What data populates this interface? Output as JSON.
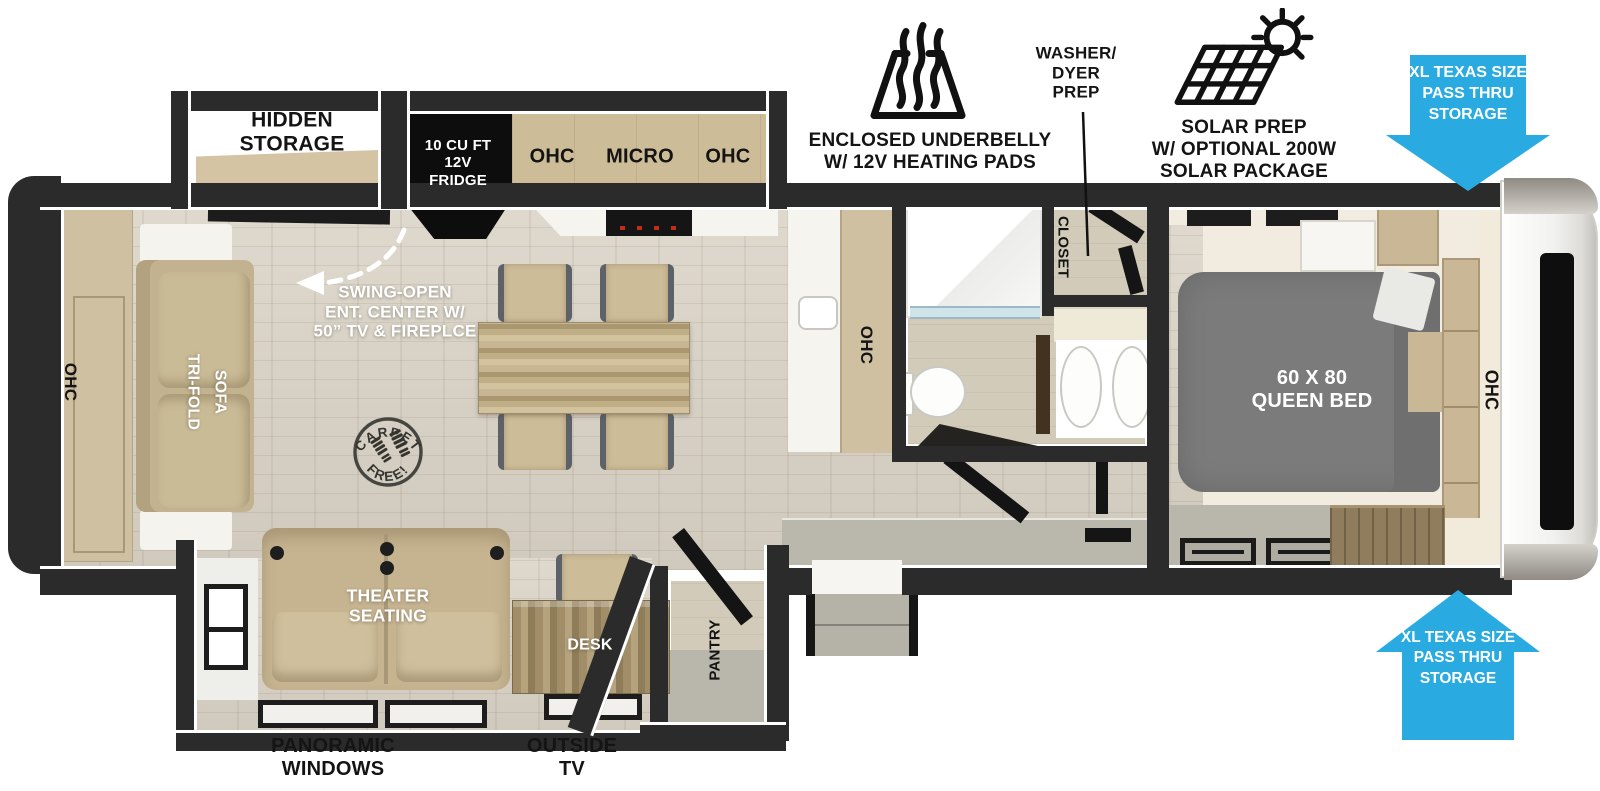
{
  "colors": {
    "accent_blue": "#29abe2",
    "wall_dark": "#2b2b2b",
    "floor_wood": "#d7d0c3",
    "cabinet_tan": "#cdbc98",
    "bed_gray": "#7b7b7b"
  },
  "annotations": {
    "underbelly": {
      "icon": "heating-pads-icon",
      "label": "ENCLOSED UNDERBELLY\nW/ 12V HEATING PADS"
    },
    "washer_dryer": {
      "label": "WASHER/\nDYER\nPREP"
    },
    "solar": {
      "icon": "solar-panel-sun-icon",
      "label": "SOLAR PREP\nW/ OPTIONAL 200W\nSOLAR PACKAGE"
    },
    "pass_thru_top": {
      "icon": "arrow-down",
      "label": "XL TEXAS SIZE\nPASS THRU\nSTORAGE"
    },
    "pass_thru_bottom": {
      "icon": "arrow-up",
      "label": "XL TEXAS SIZE\nPASS THRU\nSTORAGE"
    }
  },
  "floorplan": {
    "labels": {
      "hidden_storage": "HIDDEN\nSTORAGE",
      "fridge": "10 CU FT\n12V\nFRIDGE",
      "kitchen_ohc": "OHC  MICRO  OHC",
      "ent_center": "SWING-OPEN\nENT. CENTER W/\n50” TV & FIREPLCE",
      "carpet_free_top": "CARPET",
      "carpet_free_bottom": "FREE!",
      "rear_ohc": "OHC",
      "sofa_col_left": "TRI-FOLD",
      "sofa_col_right": "SOFA",
      "counter_ohc": "OHC",
      "closet": "CLOSET",
      "bed": "60 X 80\nQUEEN BED",
      "bedroom_ohc": "OHC",
      "theater": "THEATER\nSEATING",
      "desk": "DESK",
      "pantry": "PANTRY",
      "panoramic": "PANORAMIC\nWINDOWS",
      "outside_tv": "OUTSIDE\nTV"
    }
  }
}
